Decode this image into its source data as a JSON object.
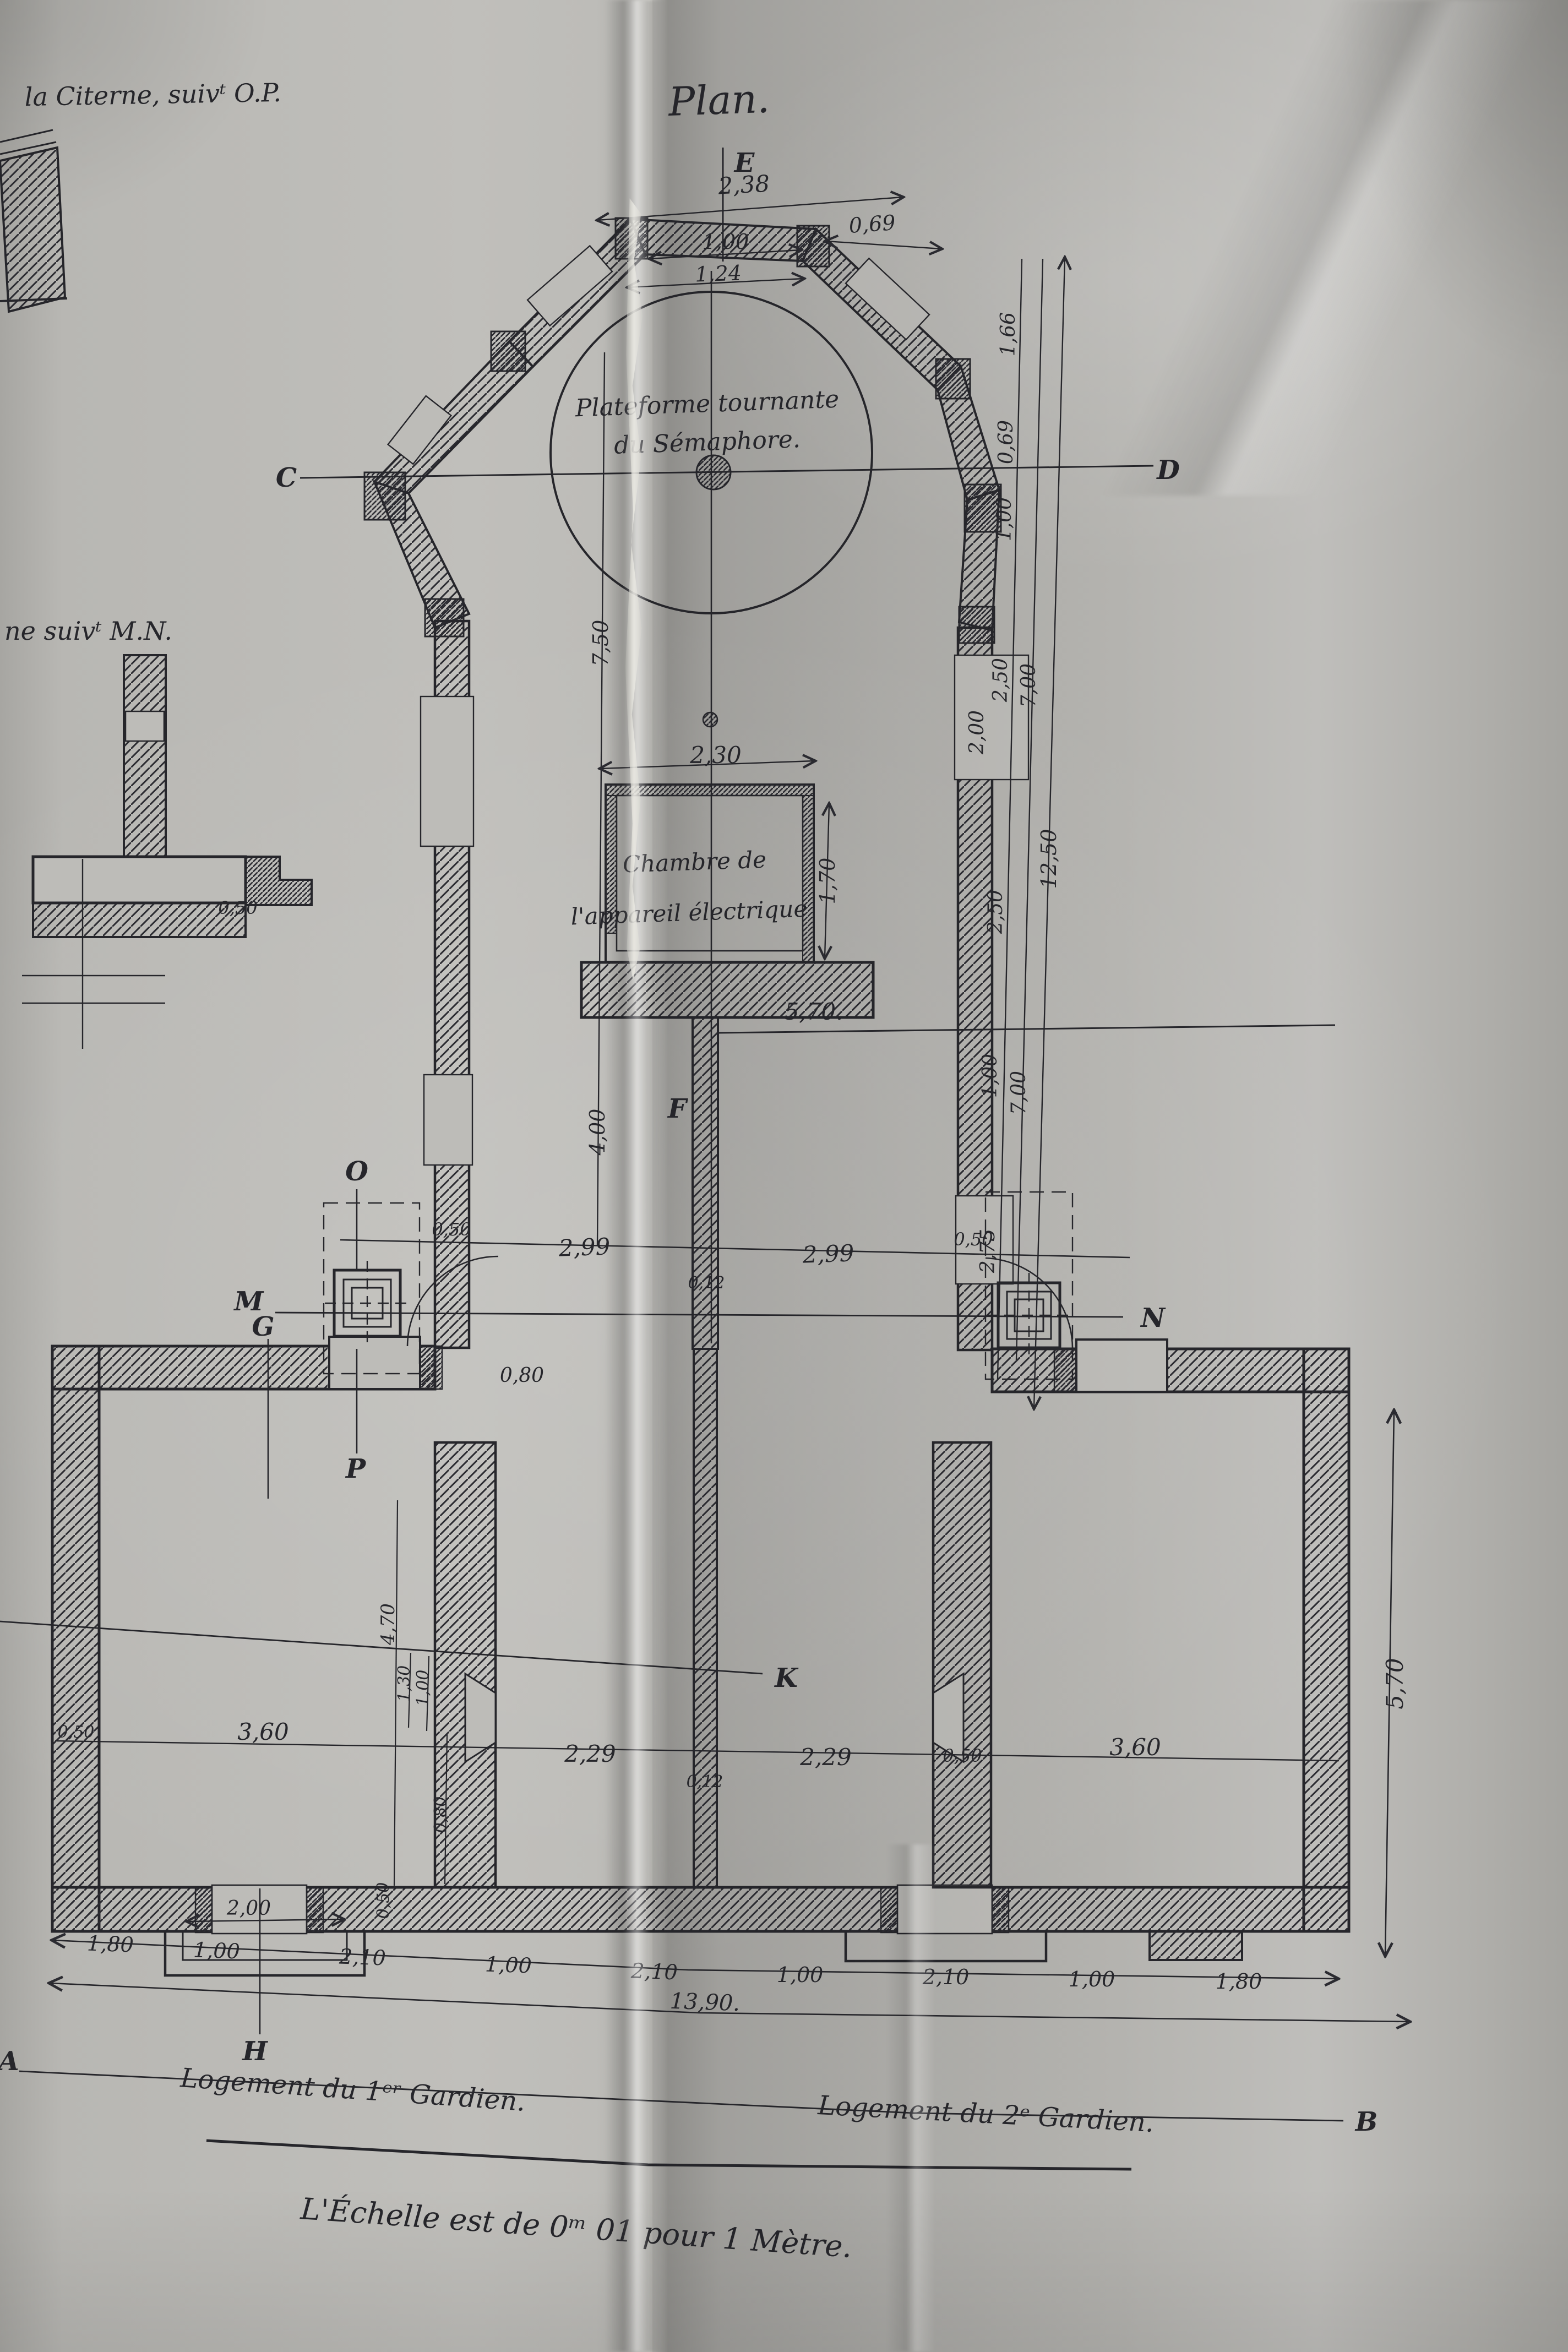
{
  "colors": {
    "ink": "#26262b",
    "paper": "#b8b7b3"
  },
  "document": {
    "title": "Plan.",
    "note_top_left": "la Citerne, suivᵗ O.P.",
    "note_mid_left": "ne suivᵗ M.N.",
    "scale_note": "L'Échelle est de 0ᵐ 01 pour 1 Mètre.",
    "platform_line1": "Plateforme tournante",
    "platform_line2": "du Sémaphore.",
    "chamber_line1": "Chambre de",
    "chamber_line2": "l'appareil électrique",
    "lodging_left": "Logement du 1ᵉʳ Gardien.",
    "lodging_right": "Logement du 2ᵉ Gardien."
  },
  "axes": {
    "E": "E",
    "C": "C",
    "D": "D",
    "F": "F",
    "K": "K",
    "M": "M",
    "N": "N",
    "O": "O",
    "G": "G",
    "P": "P",
    "H": "H",
    "A": "A",
    "B": "B"
  },
  "dims": {
    "top_total": "2,38",
    "top_mid": "1,00",
    "top_right": "0,69",
    "top_inner": "1,24",
    "r_166": "1,66",
    "r_069": "0,69",
    "r_100a": "1,00",
    "r_250a": "2,50",
    "r_250b": "2,50",
    "r_100b": "1,00",
    "r_275": "2,75",
    "r_700a": "7,00",
    "r_700b": "7,00",
    "r_1250": "12,50",
    "r_recess_200": "2,00",
    "l_750": "7,50",
    "l_400": "4,00",
    "chamber_w": "2,30",
    "chamber_h": "1,70",
    "spine_570": "5,70.",
    "row1_050l": "0,50",
    "row1_299l": "2,99",
    "row1_012": "0,12",
    "row1_299r": "2,99",
    "row1_050r": "0,50",
    "door_080": "0,80",
    "row2_050l": "0,50",
    "row2_360l": "3,60",
    "chim_470": "4,70",
    "chim_130": "1,30",
    "chim_100": "1,00",
    "chim_080": "0,80",
    "row2_229l": "2,29",
    "row2_012": "0,12",
    "row2_229r": "2,29",
    "row2_050r": "0,50",
    "row2_360r": "3,60",
    "right_570": "5,70",
    "porch_200": "2,00",
    "porch_050": "0,50",
    "chain": [
      "1,80",
      "1,00",
      "2,10",
      "1,00",
      "2,10",
      "1,00",
      "2,10",
      "1,00",
      "1,80"
    ],
    "bottom_total": "13,90.",
    "section_050": "0,50"
  }
}
